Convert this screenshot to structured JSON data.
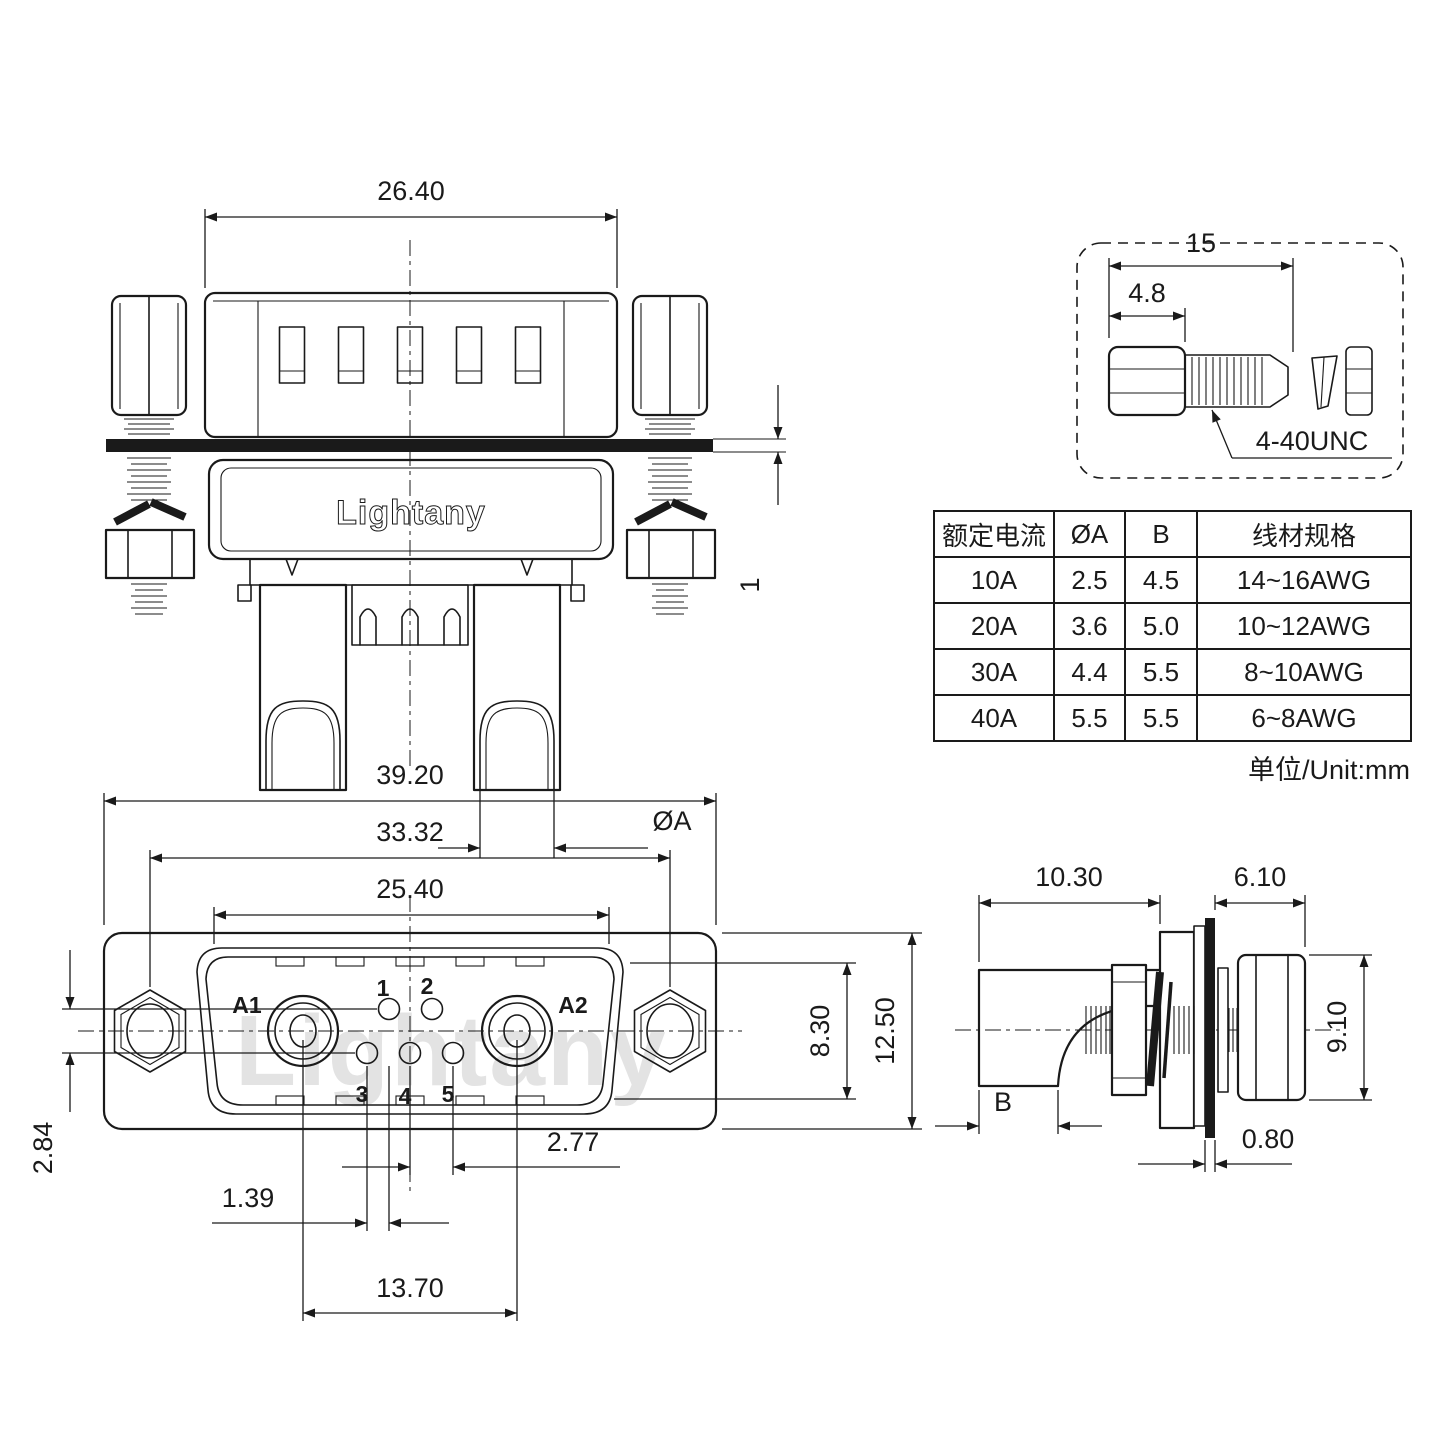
{
  "brand": {
    "logo": "Lightany",
    "watermark": "Lightany"
  },
  "top_view": {
    "dim_width": "26.40",
    "dim_panel_thickness": "1",
    "dim_hole_dia": "ØA"
  },
  "screw_detail": {
    "dim_total_length": "15",
    "dim_head_length": "4.8",
    "thread_spec": "4-40UNC"
  },
  "spec_table": {
    "headers": [
      "额定电流",
      "ØA",
      "B",
      "线材规格"
    ],
    "rows": [
      [
        "10A",
        "2.5",
        "4.5",
        "14~16AWG"
      ],
      [
        "20A",
        "3.6",
        "5.0",
        "10~12AWG"
      ],
      [
        "30A",
        "4.4",
        "5.5",
        "8~10AWG"
      ],
      [
        "40A",
        "5.5",
        "5.5",
        "6~8AWG"
      ]
    ],
    "unit_note": "单位/Unit:mm"
  },
  "front_view": {
    "dim_overall_width": "39.20",
    "dim_mount_pitch": "33.32",
    "dim_insert_width": "25.40",
    "dim_row_offset": "2.84",
    "dim_pin_pitch": "2.77",
    "dim_row_stagger": "1.39",
    "dim_power_pitch": "13.70",
    "dim_insert_height": "8.30",
    "dim_flange_height": "12.50",
    "pin_labels": {
      "a1": "A1",
      "a2": "A2",
      "p1": "1",
      "p2": "2",
      "p3": "3",
      "p4": "4",
      "p5": "5"
    }
  },
  "side_view": {
    "dim_front_depth": "10.30",
    "dim_rear_depth": "6.10",
    "dim_nut_height": "9.10",
    "dim_cup_id": "B",
    "dim_panel_thickness": "0.80"
  }
}
